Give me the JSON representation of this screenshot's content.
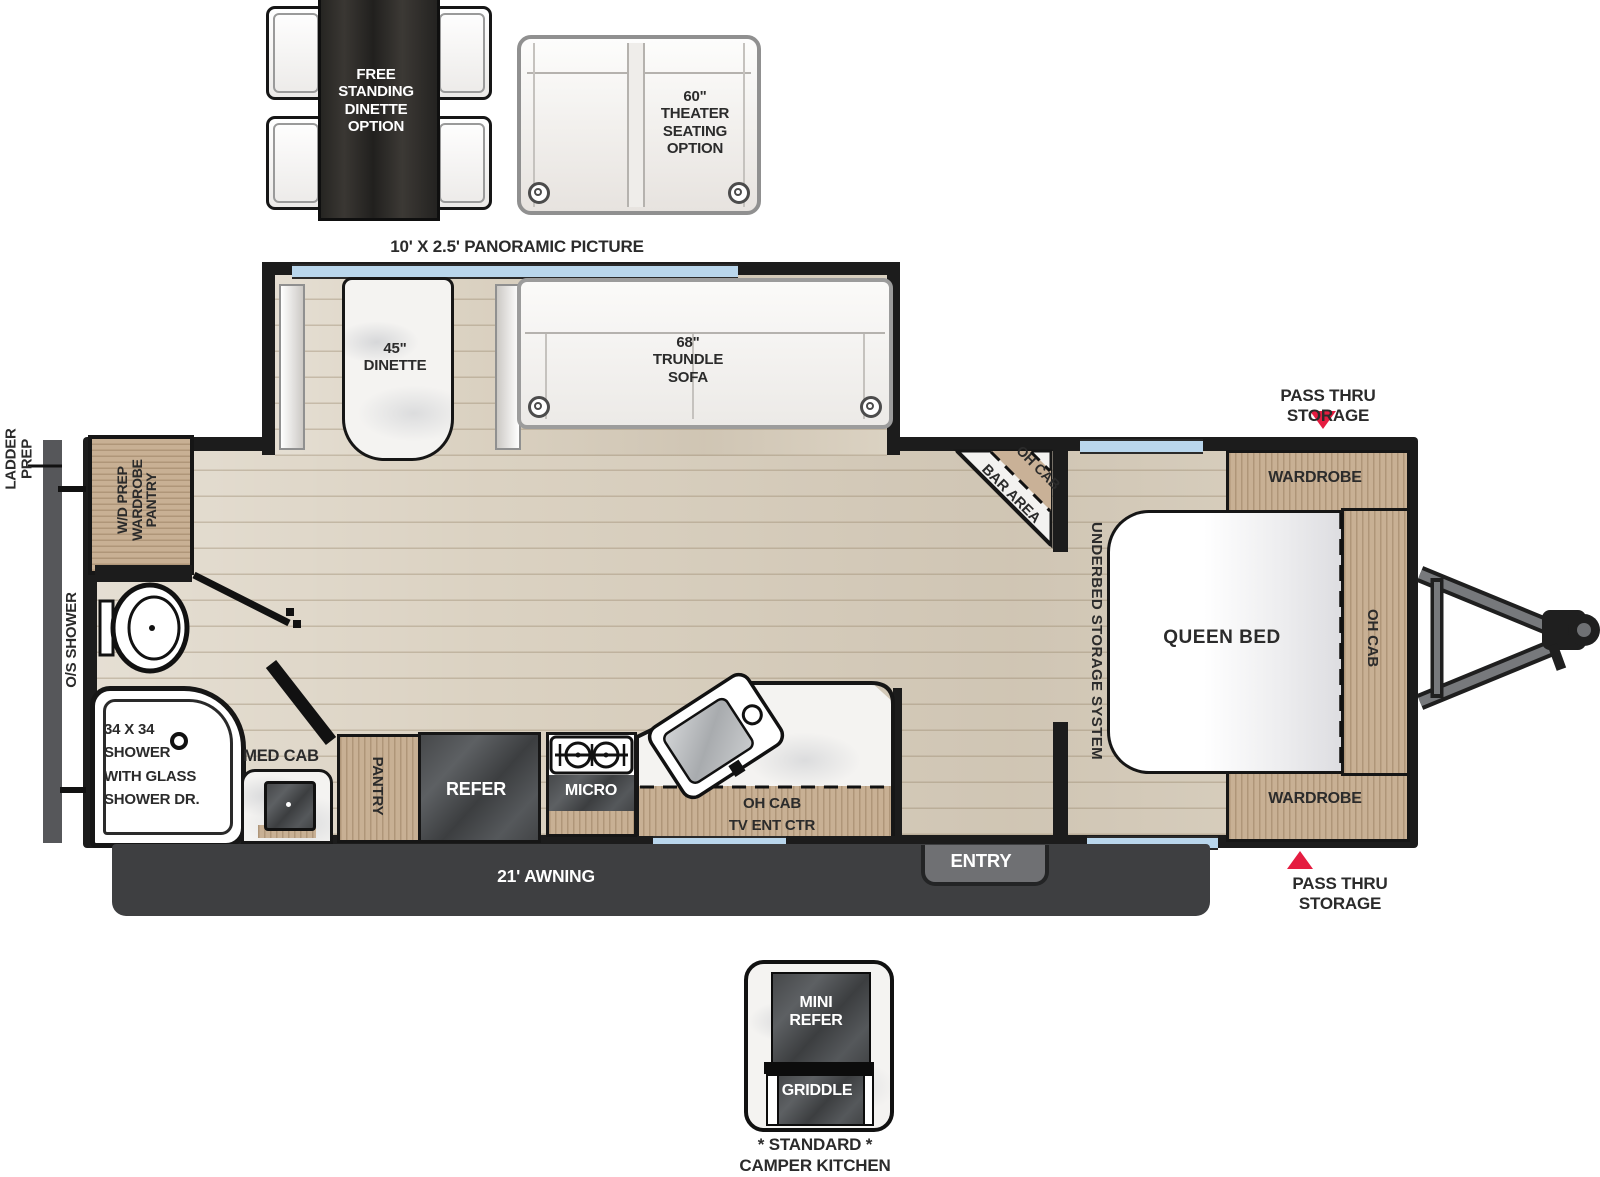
{
  "options": {
    "free_standing_dinette": "FREE\nSTANDING\nDINETTE\nOPTION",
    "theater_seating": "60\"\nTHEATER\nSEATING\nOPTION",
    "panoramic_picture": "10' X 2.5' PANORAMIC PICTURE"
  },
  "slide_out": {
    "dinette": "45\"\nDINETTE",
    "trundle_sofa": "68\"\nTRUNDLE\nSOFA"
  },
  "bedroom": {
    "pass_thru_top": "PASS THRU STORAGE",
    "pass_thru_bottom": "PASS THRU STORAGE",
    "wardrobe_top": "WARDROBE",
    "wardrobe_bottom": "WARDROBE",
    "queen_bed": "QUEEN BED",
    "oh_cab": "OH CAB",
    "underbed_storage": "UNDERBED STORAGE SYSTEM"
  },
  "bar": {
    "oh_cab": "OH CAB",
    "bar_area": "BAR AREA"
  },
  "bathroom": {
    "ladder_prep": "LADDER\nPREP",
    "os_shower": "O/S SHOWER",
    "wd_prep": "W/D PREP\nWARDROBE\nPANTRY",
    "shower": "34 X 34\nSHOWER\nWITH GLASS\nSHOWER DR.",
    "med_cab": "MED CAB"
  },
  "kitchen": {
    "pantry": "PANTRY",
    "refer": "REFER",
    "micro": "MICRO",
    "oh_cab_tv": "OH CAB\nTV ENT CTR"
  },
  "exterior": {
    "awning": "21' AWNING",
    "entry": "ENTRY"
  },
  "camper_kitchen": {
    "mini_refer": "MINI\nREFER",
    "griddle": "GRIDDLE",
    "caption": "* STANDARD *\nCAMPER KITCHEN"
  },
  "colors": {
    "accent_red": "#e51c40",
    "window_blue": "#b9d6ec",
    "wood": "#c8b094",
    "wall": "#1c1c1c"
  }
}
